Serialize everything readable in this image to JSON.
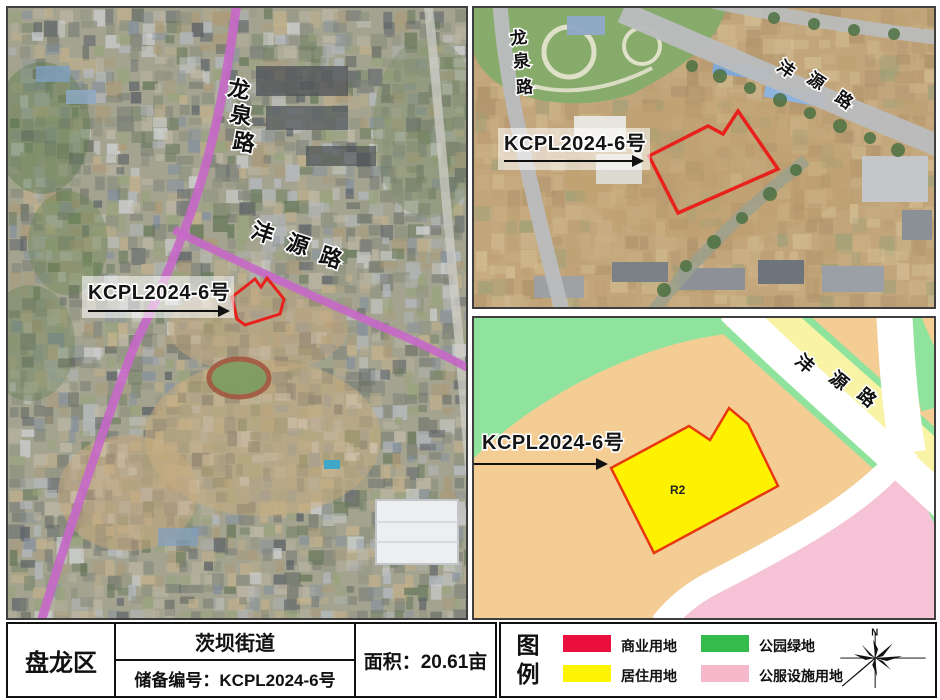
{
  "maps": {
    "overview": {
      "parcel_label": "KCPL2024-6号",
      "roads": {
        "longquan": "龙泉路",
        "fengyuan": "沣源路"
      }
    },
    "detail": {
      "parcel_label": "KCPL2024-6号",
      "roads": {
        "longquan": "龙泉路",
        "fengyuan": "沣源路"
      }
    },
    "zoning": {
      "parcel_label": "KCPL2024-6号",
      "zone_code": "R2",
      "roads": {
        "fengyuan": "沣源路"
      }
    }
  },
  "info_table": {
    "district": "盘龙区",
    "street": "茨坝街道",
    "reserve_label": "储备编号：",
    "reserve_no": "KCPL2024-6号",
    "area_label": "面积：",
    "area_value": "20.61亩"
  },
  "legend": {
    "title": "图例",
    "items": [
      {
        "label": "商业用地",
        "color": "#ea0f3c"
      },
      {
        "label": "居住用地",
        "color": "#fcf400"
      },
      {
        "label": "公园绿地",
        "color": "#35bb4b"
      },
      {
        "label": "公服设施用地",
        "color": "#f6b9cb"
      }
    ],
    "compass_north": "N"
  },
  "zoning_colors": {
    "residential_parcel": "#fff200",
    "parcel_outline": "#e8380d",
    "orange_area": "#f4cd95",
    "green_area": "#90e39c",
    "pink_area": "#f6c3d6",
    "pale_yellow_area": "#f9f3a5",
    "road": "#ffffff"
  }
}
